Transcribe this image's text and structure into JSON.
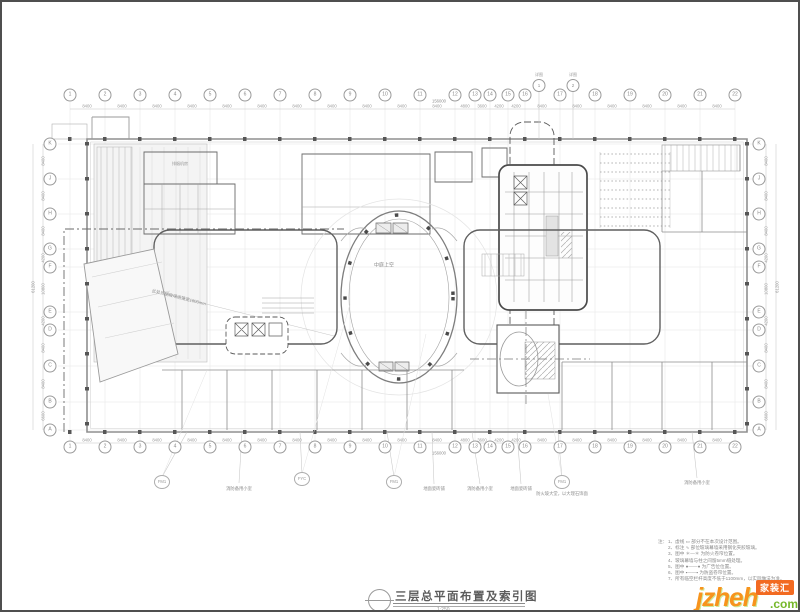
{
  "titleblock": {
    "title": "三层总平面布置及索引图",
    "scale": "1:250"
  },
  "grid": {
    "top": [
      {
        "x": 68,
        "label": "1"
      },
      {
        "x": 103,
        "label": "2"
      },
      {
        "x": 138,
        "label": "3"
      },
      {
        "x": 173,
        "label": "4"
      },
      {
        "x": 208,
        "label": "5"
      },
      {
        "x": 243,
        "label": "6"
      },
      {
        "x": 278,
        "label": "7"
      },
      {
        "x": 313,
        "label": "8"
      },
      {
        "x": 348,
        "label": "9"
      },
      {
        "x": 383,
        "label": "10"
      },
      {
        "x": 418,
        "label": "11"
      },
      {
        "x": 453,
        "label": "12"
      },
      {
        "x": 473,
        "label": "13"
      },
      {
        "x": 488,
        "label": "14"
      },
      {
        "x": 506,
        "label": "15"
      },
      {
        "x": 523,
        "label": "16"
      },
      {
        "x": 558,
        "label": "17"
      },
      {
        "x": 593,
        "label": "18"
      },
      {
        "x": 628,
        "label": "19"
      },
      {
        "x": 663,
        "label": "20"
      },
      {
        "x": 698,
        "label": "21"
      },
      {
        "x": 733,
        "label": "22"
      }
    ],
    "side": [
      {
        "y": 142,
        "label": "K"
      },
      {
        "y": 177,
        "label": "J"
      },
      {
        "y": 212,
        "label": "H"
      },
      {
        "y": 247,
        "label": "G"
      },
      {
        "y": 265,
        "label": "F"
      },
      {
        "y": 310,
        "label": "E"
      },
      {
        "y": 328,
        "label": "D"
      },
      {
        "y": 364,
        "label": "C"
      },
      {
        "y": 400,
        "label": "B"
      },
      {
        "y": 428,
        "label": "A"
      }
    ],
    "top_dims": [
      {
        "x": 85,
        "label": "8400"
      },
      {
        "x": 120,
        "label": "8400"
      },
      {
        "x": 155,
        "label": "8400"
      },
      {
        "x": 190,
        "label": "8400"
      },
      {
        "x": 225,
        "label": "8400"
      },
      {
        "x": 260,
        "label": "8400"
      },
      {
        "x": 295,
        "label": "8400"
      },
      {
        "x": 330,
        "label": "8400"
      },
      {
        "x": 365,
        "label": "8400"
      },
      {
        "x": 400,
        "label": "8400"
      },
      {
        "x": 435,
        "label": "8400"
      },
      {
        "x": 463,
        "label": "4800"
      },
      {
        "x": 480,
        "label": "3600"
      },
      {
        "x": 497,
        "label": "4200"
      },
      {
        "x": 514,
        "label": "4200"
      },
      {
        "x": 540,
        "label": "8400"
      },
      {
        "x": 575,
        "label": "8400"
      },
      {
        "x": 610,
        "label": "8400"
      },
      {
        "x": 645,
        "label": "8400"
      },
      {
        "x": 680,
        "label": "8400"
      },
      {
        "x": 715,
        "label": "8400"
      }
    ],
    "side_dims": [
      {
        "y": 159,
        "label": "8400"
      },
      {
        "y": 194,
        "label": "8400"
      },
      {
        "y": 229,
        "label": "8400"
      },
      {
        "y": 256,
        "label": "4200"
      },
      {
        "y": 287,
        "label": "10800"
      },
      {
        "y": 319,
        "label": "4200"
      },
      {
        "y": 346,
        "label": "8400"
      },
      {
        "y": 382,
        "label": "8400"
      },
      {
        "y": 414,
        "label": "6600"
      }
    ],
    "total_width": "156000",
    "total_height": "61200"
  },
  "plan": {
    "atrium_label": "中庭上空",
    "room_labels": [
      {
        "x": 178,
        "y": 162,
        "label": "排烟机房"
      }
    ],
    "canopy_note": "此处顶棚玻璃雨篷宽1800mm"
  },
  "callouts": {
    "top_markers": [
      {
        "x": 537,
        "label": "详图",
        "num": "1"
      },
      {
        "x": 571,
        "label": "详图",
        "num": "2"
      }
    ],
    "bottom": [
      {
        "x": 160,
        "y": 480,
        "sym": "FM1"
      },
      {
        "x": 237,
        "y": 487,
        "label": "消防备用小室"
      },
      {
        "x": 300,
        "y": 477,
        "sym": "FYC"
      },
      {
        "x": 392,
        "y": 480,
        "sym": "FM1"
      },
      {
        "x": 432,
        "y": 487,
        "label": "地面瓷砖铺"
      },
      {
        "x": 478,
        "y": 487,
        "label": "消防备用小室"
      },
      {
        "x": 519,
        "y": 487,
        "label": "地面瓷砖铺"
      },
      {
        "x": 560,
        "y": 480,
        "sym": "FM1"
      },
      {
        "x": 560,
        "y": 492,
        "label": "防火玻大堂，以大理石饰面"
      },
      {
        "x": 695,
        "y": 481,
        "label": "消防备用小室"
      }
    ]
  },
  "notes": {
    "heading": "注：",
    "lines": [
      "1、虚线 ▭ 部分不在本次设计范围。",
      "2、标注 ∿ 部位玻璃幕墙采用钢化夹胶玻璃。",
      "3、图中 ＊—＊ 为防火卷帘位置。",
      "4、玻璃幕墙与柱之间留5mm缝处理。",
      "5、图中 ●——● 为广告位位置。",
      "6、图中 ▪——▪ 为防盗卷帘位置。",
      "7、所有临空栏杆高度不低于1100mm，以实际做法为准。"
    ]
  },
  "watermark": {
    "name": "jzheh",
    "tld": ".com",
    "badge": "家装汇"
  },
  "colors": {
    "accent_orange": "#f7941d",
    "accent_green": "#76b82a",
    "badge_bg": "#f26a21"
  }
}
